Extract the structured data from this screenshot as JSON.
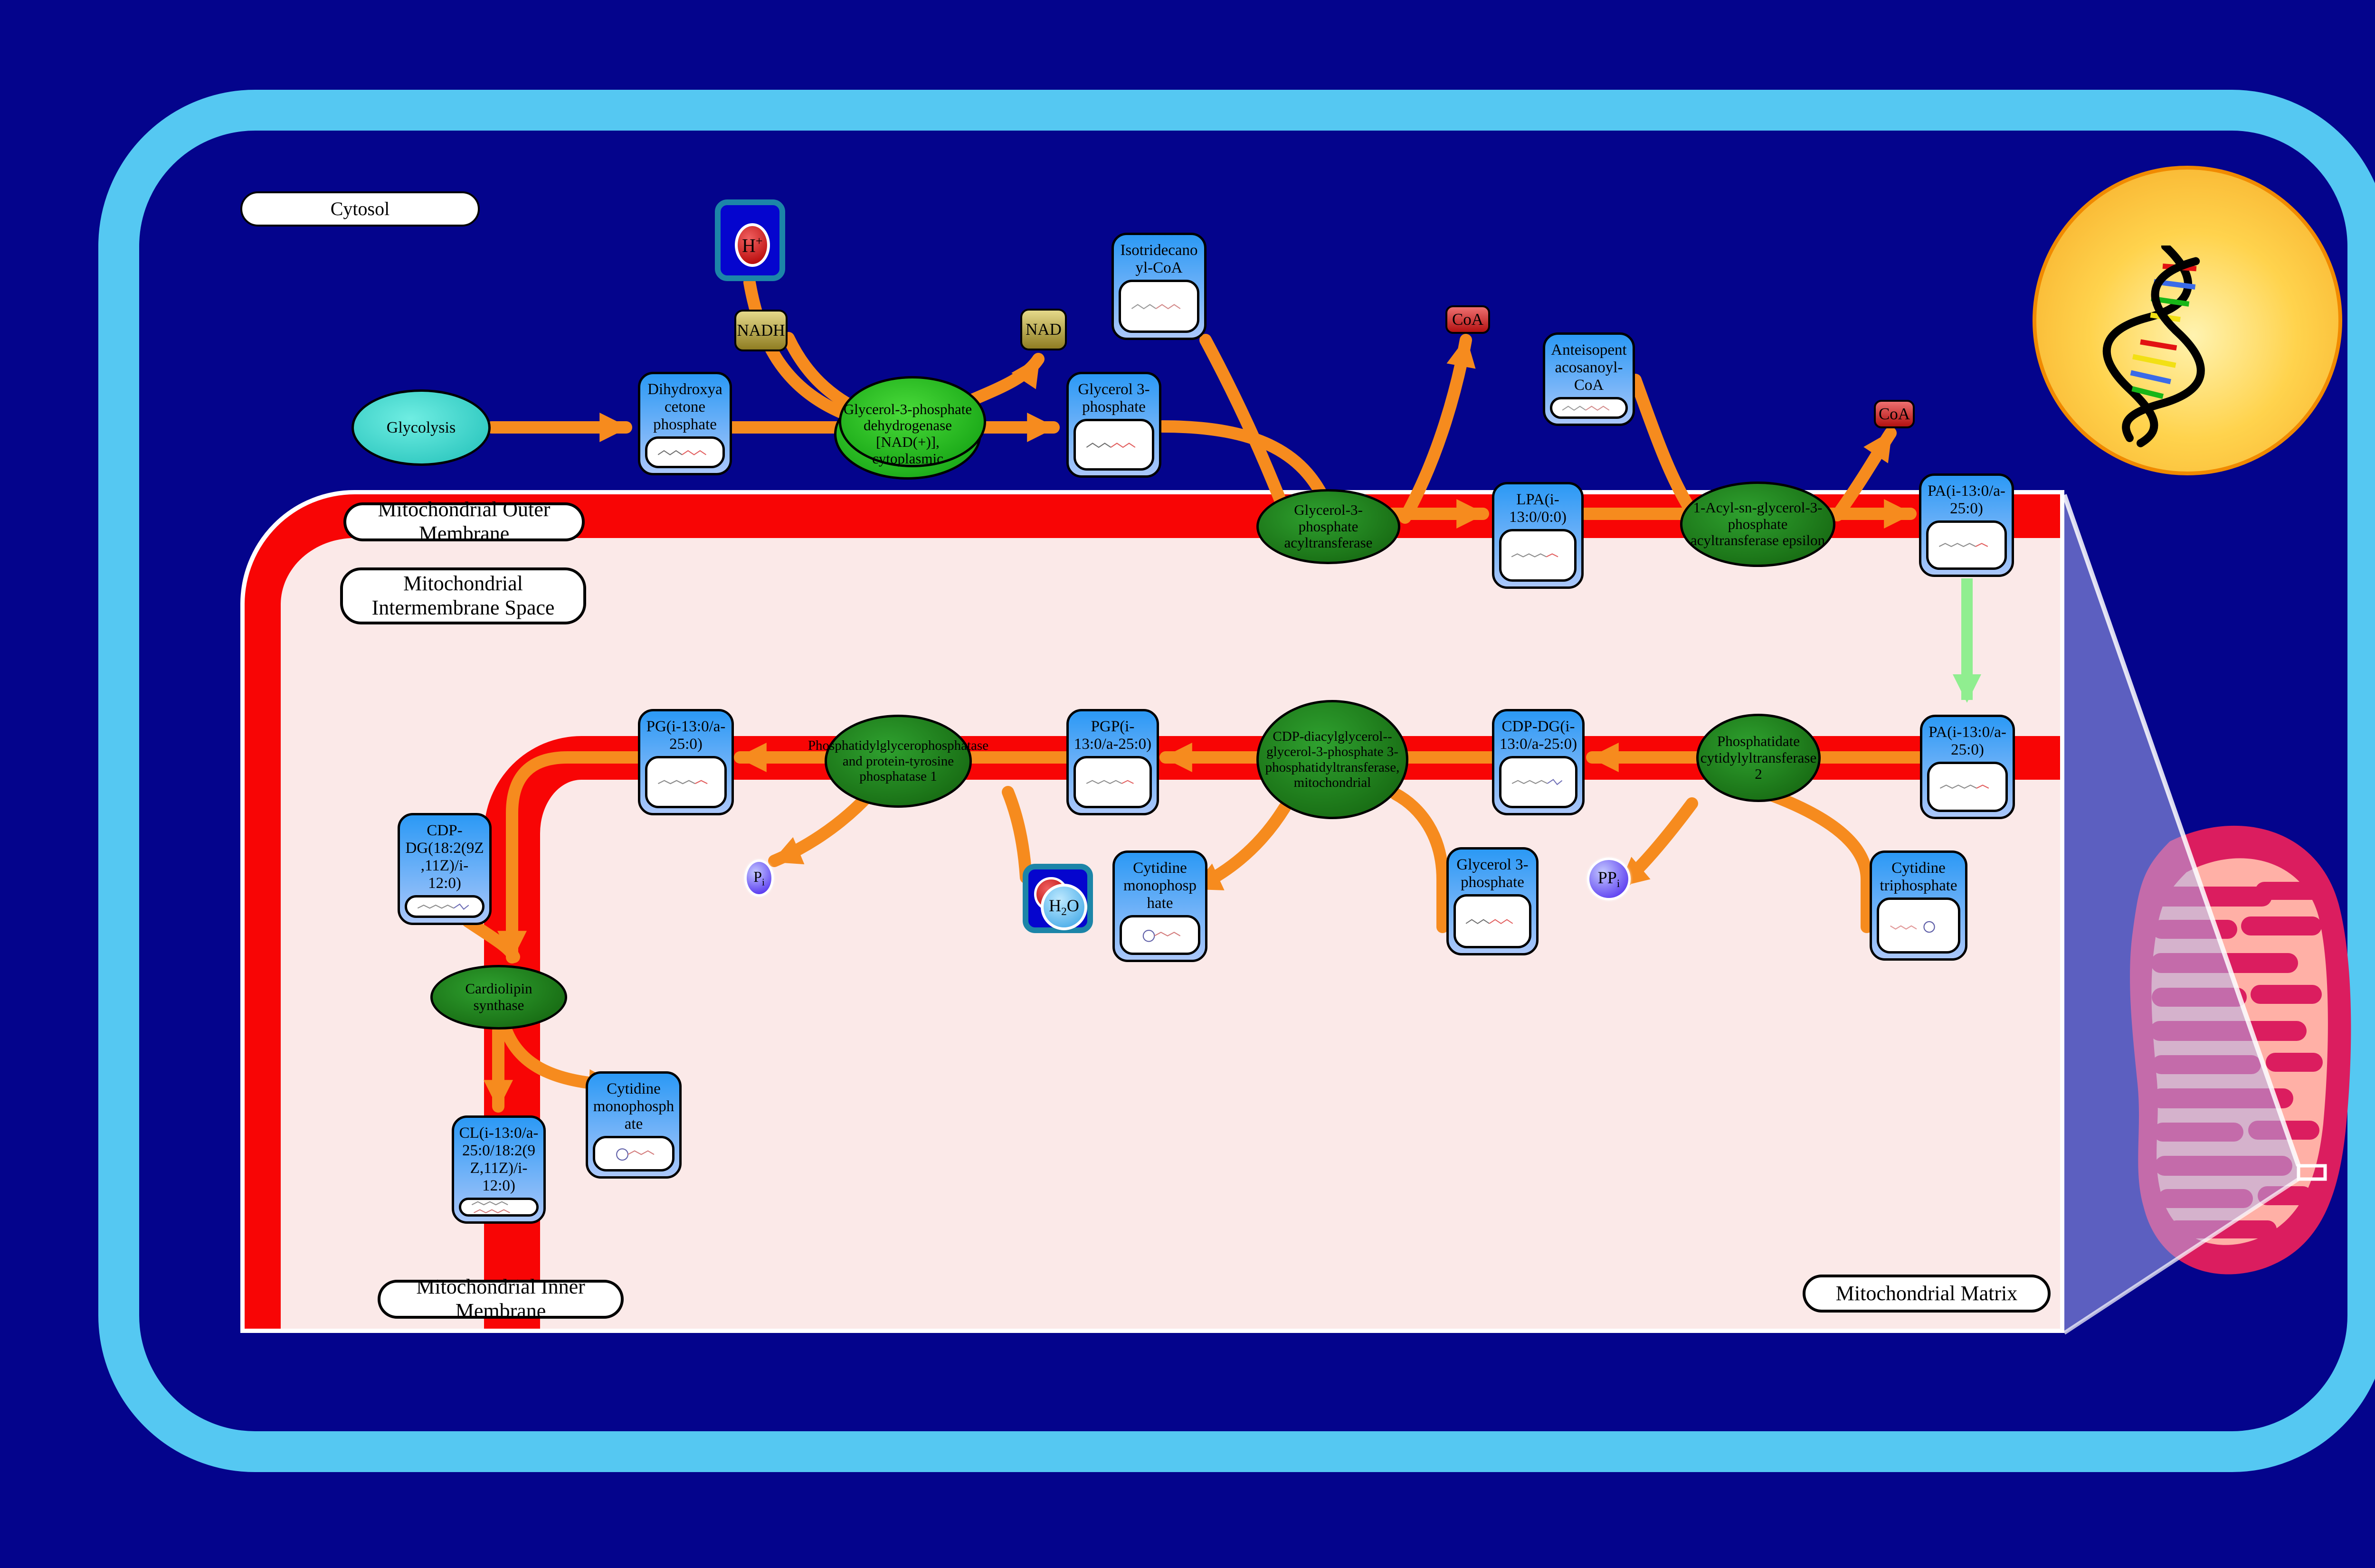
{
  "regions": {
    "cytosol": "Cytosol",
    "outer_membrane": "Mitochondrial Outer Membrane",
    "intermembrane_space": "Mitochondrial Intermembrane Space",
    "inner_membrane": "Mitochondrial Inner Membrane",
    "matrix": "Mitochondrial Matrix"
  },
  "process": {
    "glycolysis": "Glycolysis"
  },
  "metabolites": {
    "dhap": "Dihydroxyacetone phosphate",
    "g3p_cytosol": "Glycerol 3-phosphate",
    "isotridecanoyl_coa": "Isotridecanoyl-CoA",
    "anteisopentacosanoyl_coa": "Anteisopentacosanoyl-CoA",
    "lpa": "LPA(i-13:0/0:0)",
    "pa_outer": "PA(i-13:0/a-25:0)",
    "pa_inner": "PA(i-13:0/a-25:0)",
    "cdp_dg_inner": "CDP-DG(i-13:0/a-25:0)",
    "ctp": "Cytidine triphosphate",
    "g3p_matrix": "Glycerol 3-phosphate",
    "pgp": "PGP(i-13:0/a-25:0)",
    "cmp_1": "Cytidine monophosphate",
    "pg": "PG(i-13:0/a-25:0)",
    "cdp_dg_left": "CDP-DG(18:2(9Z,11Z)/i-12:0)",
    "cl": "CL(i-13:0/a-25:0/18:2(9Z,11Z)/i-12:0)",
    "cmp_2": "Cytidine monophosphate"
  },
  "enzymes": {
    "g3p_dehydrogenase": "Glycerol-3-phosphate dehydrogenase [NAD(+)], cytoplasmic",
    "g3p_acyltransferase": "Glycerol-3-phosphate acyltransferase",
    "agpat_epsilon": "1-Acyl-sn-glycerol-3-phosphate acyltransferase epsilon",
    "pc2": "Phosphatidate cytidylyltransferase 2",
    "cdp_dag_pt": "CDP-diacylglycerol--glycerol-3-phosphate 3-phosphatidyltransferase, mitochondrial",
    "pgp_phosphatase": "Phosphatidylglycerophosphatase and protein-tyrosine phosphatase 1",
    "cl_synthase": "Cardiolipin synthase"
  },
  "cofactors": {
    "nadh": "NADH",
    "nad": "NAD",
    "h_base": "H",
    "h_sup": "+",
    "h2o_1": "H",
    "h2o_sub": "2",
    "h2o_2": "O",
    "coa_1": "CoA",
    "coa_2": "CoA",
    "ppi_base": "PP",
    "ppi_sub": "i",
    "pi_base": "P",
    "pi_sub": "i"
  },
  "colors": {
    "background": "#04048C",
    "cell_border": "#55C8F2",
    "membrane_red": "#F80505",
    "intermembrane_pink": "#FBE9E8",
    "arrow_orange": "#F68B1E",
    "transport_arrow_green": "#90EE90",
    "metabolite_box_blue": "#2B99F5",
    "enzyme_green": "#1E7D1E",
    "nucleus_gold": "#F5A623",
    "mitochondrion_crimson": "#DB1D5F"
  }
}
